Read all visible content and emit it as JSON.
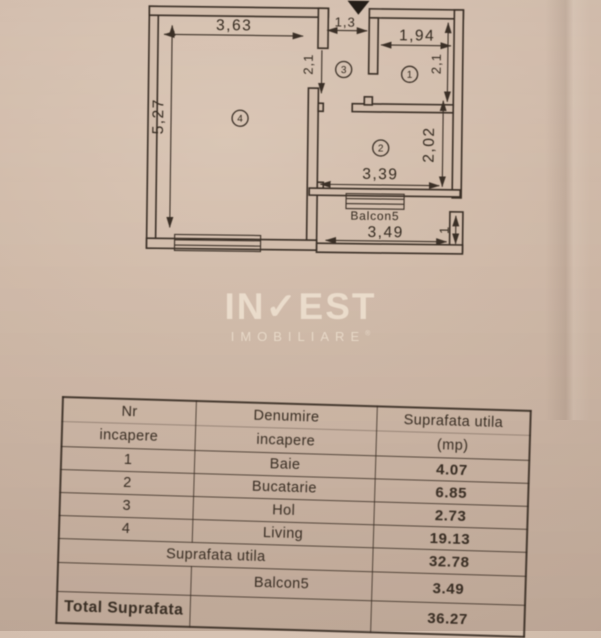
{
  "floorplan": {
    "dims": {
      "living_width": "3,63",
      "living_height": "5,27",
      "entry_width": "1,3",
      "room1_width": "1,94",
      "room1_height": "2,1",
      "hol_height": "2,1",
      "room2_width": "3,39",
      "room2_height": "2,02",
      "balcony_width": "3,49",
      "balcony_depth": "1"
    },
    "labels": {
      "balcony": "Balcon5"
    },
    "room_numbers": {
      "baie": "1",
      "bucatarie": "2",
      "hol": "3",
      "living": "4"
    }
  },
  "logo": {
    "name_part1": "IN",
    "check": "✓",
    "name_part2": "EST",
    "subtitle": "IMOBILIARE",
    "registered": "®"
  },
  "table": {
    "headers": {
      "col1_line1": "Nr",
      "col1_line2": "incapere",
      "col2_line1": "Denumire",
      "col2_line2": "incapere",
      "col3_line1": "Suprafata utila",
      "col3_line2": "(mp)"
    },
    "rows": [
      {
        "nr": "1",
        "name": "Baie",
        "area": "4.07"
      },
      {
        "nr": "2",
        "name": "Bucatarie",
        "area": "6.85"
      },
      {
        "nr": "3",
        "name": "Hol",
        "area": "2.73"
      },
      {
        "nr": "4",
        "name": "Living",
        "area": "19.13"
      }
    ],
    "summary": {
      "utila_label": "Suprafata utila",
      "utila_value": "32.78",
      "balcon_label": "Balcon5",
      "balcon_value": "3.49",
      "total_label": "Total Suprafata",
      "total_value": "36.27"
    }
  },
  "colors": {
    "paper": "#cfb9a8",
    "ink": "#3a2f26",
    "watermark": "#eadbc8"
  }
}
